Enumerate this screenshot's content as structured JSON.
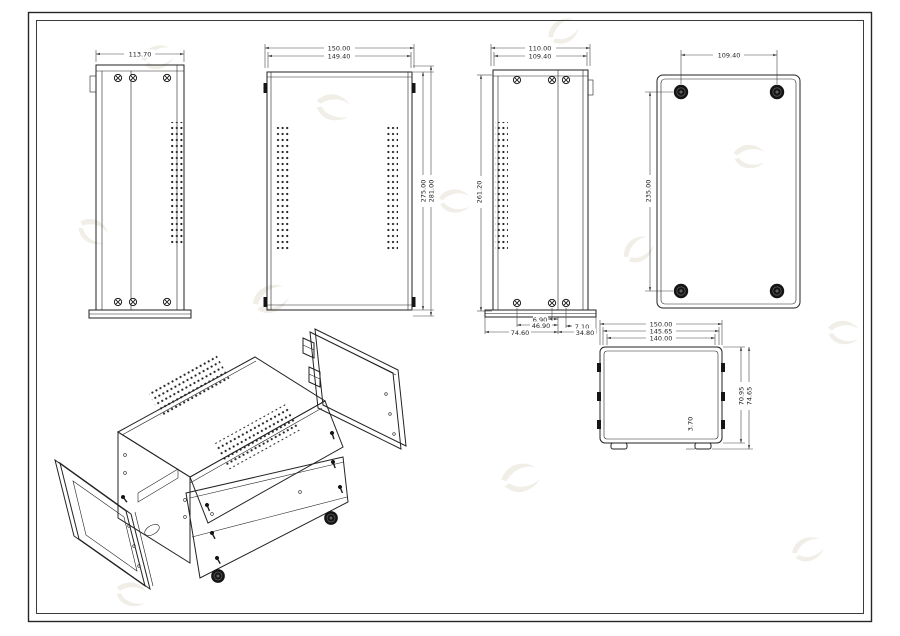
{
  "colors": {
    "background": "#ffffff",
    "line": "#222222",
    "dimension_line": "#454545",
    "watermark": "#e9e3da"
  },
  "views": {
    "side_panel": {
      "width_dim": "113.70"
    },
    "top_cover": {
      "width_outer": "150.00",
      "width_inner": "149.40",
      "height_inner": "275.00",
      "height_outer": "281.00"
    },
    "bottom_panel": {
      "width_outer": "110.00",
      "width_inner": "109.40",
      "height": "261.20",
      "cutout_dims": {
        "d1": "6.90",
        "d2": "46.90",
        "d3": "7.10",
        "d4": "74.60",
        "d5": "34.80"
      }
    },
    "base_plate": {
      "feet_span_width": "109.40",
      "feet_span_height": "235.00"
    },
    "front_panel": {
      "width_outer": "150.00",
      "width_mid": "145.65",
      "width_inner": "140.00",
      "height_inner": "70.95",
      "height_outer": "74.65",
      "foot_height": "3.70"
    }
  }
}
